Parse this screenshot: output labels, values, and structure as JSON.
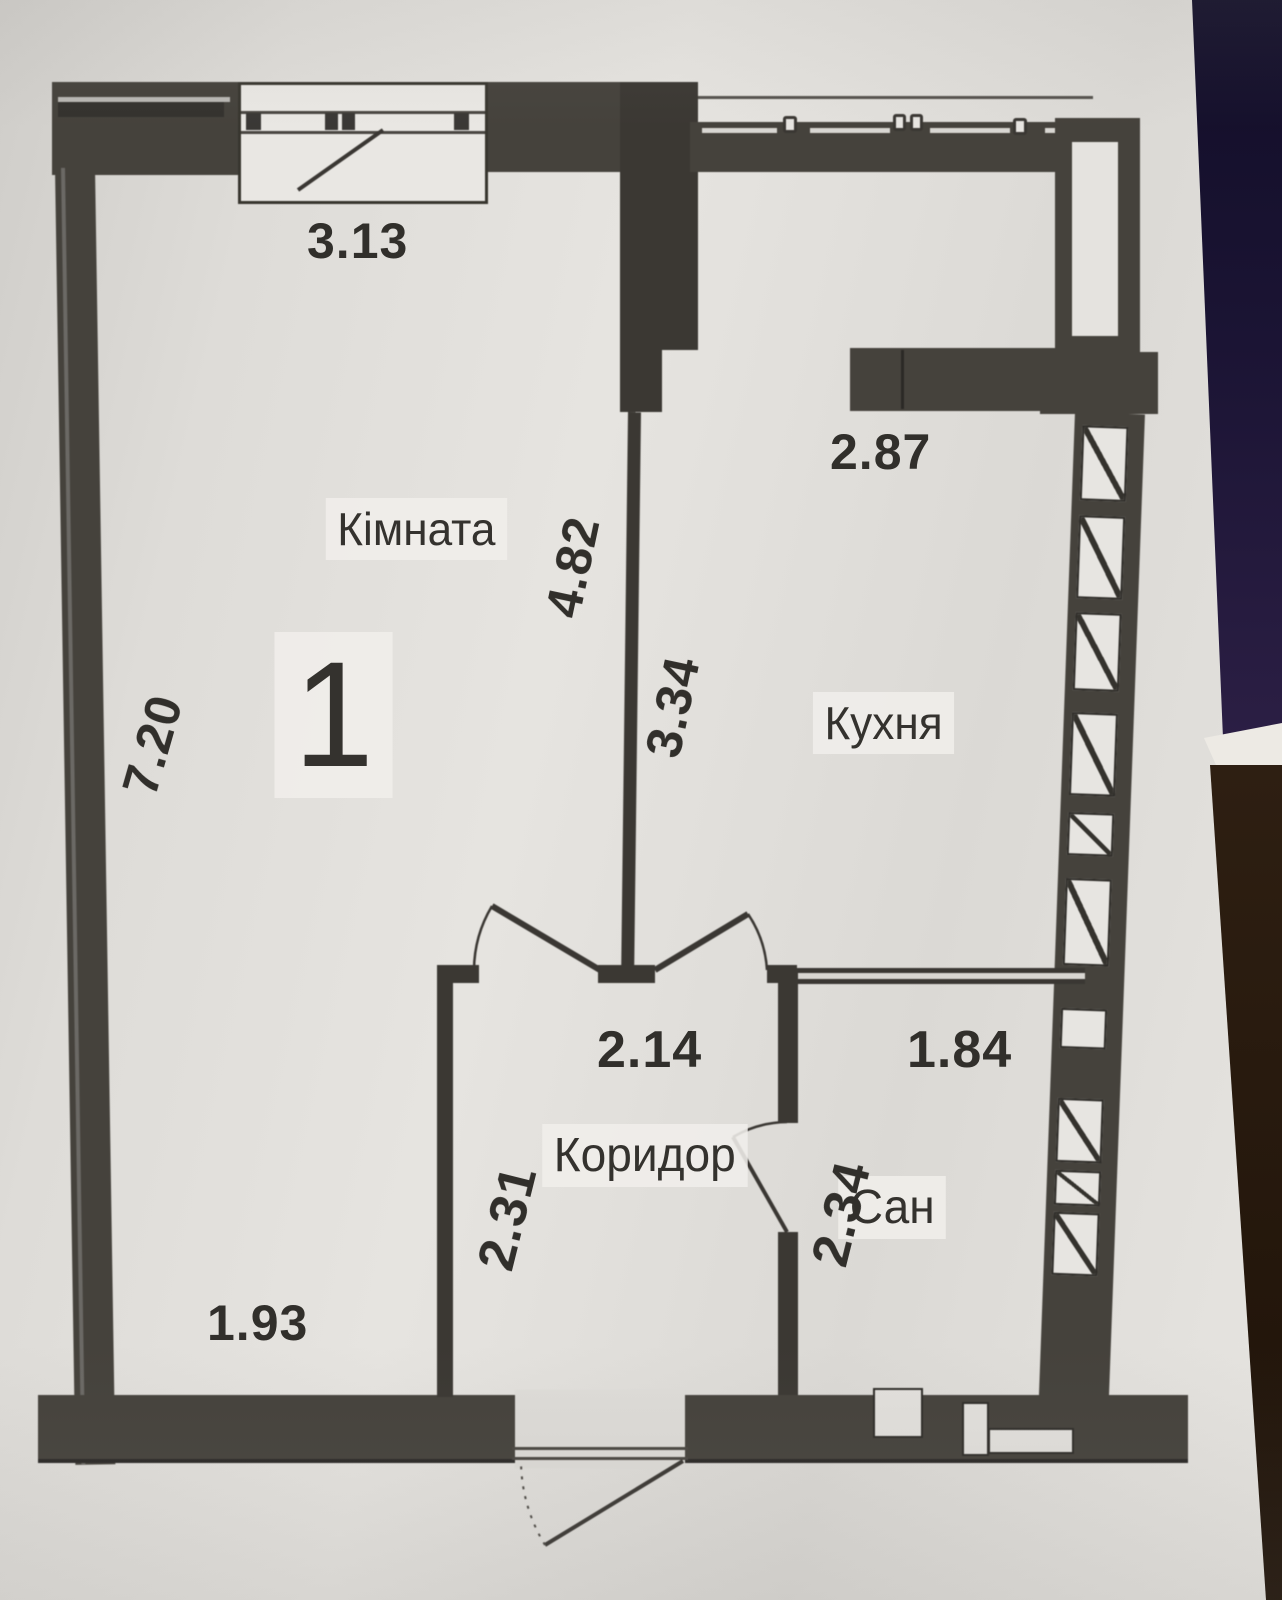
{
  "apartment": {
    "number": "1"
  },
  "rooms": {
    "room": {
      "label": "Кімната"
    },
    "kitchen": {
      "label": "Кухня"
    },
    "corridor": {
      "label": "Коридор"
    },
    "bathroom": {
      "label": "Сан"
    }
  },
  "dimensions_m": {
    "window_top": "3.13",
    "kitchen_top": "2.87",
    "room_width": "4.82",
    "kitchen_depth": "3.34",
    "room_depth": "7.20",
    "corridor_width": "2.14",
    "bathroom_width": "1.84",
    "corridor_depth": "2.31",
    "bathroom_depth": "2.34",
    "room_bottom": "1.93"
  },
  "colors": {
    "wall": "#45423c",
    "paper": "#e0deda",
    "photo_background_top": "#17122e",
    "photo_background_purple": "#2c1f45",
    "photo_background_bottom": "#241709",
    "text": "#312f2b"
  }
}
